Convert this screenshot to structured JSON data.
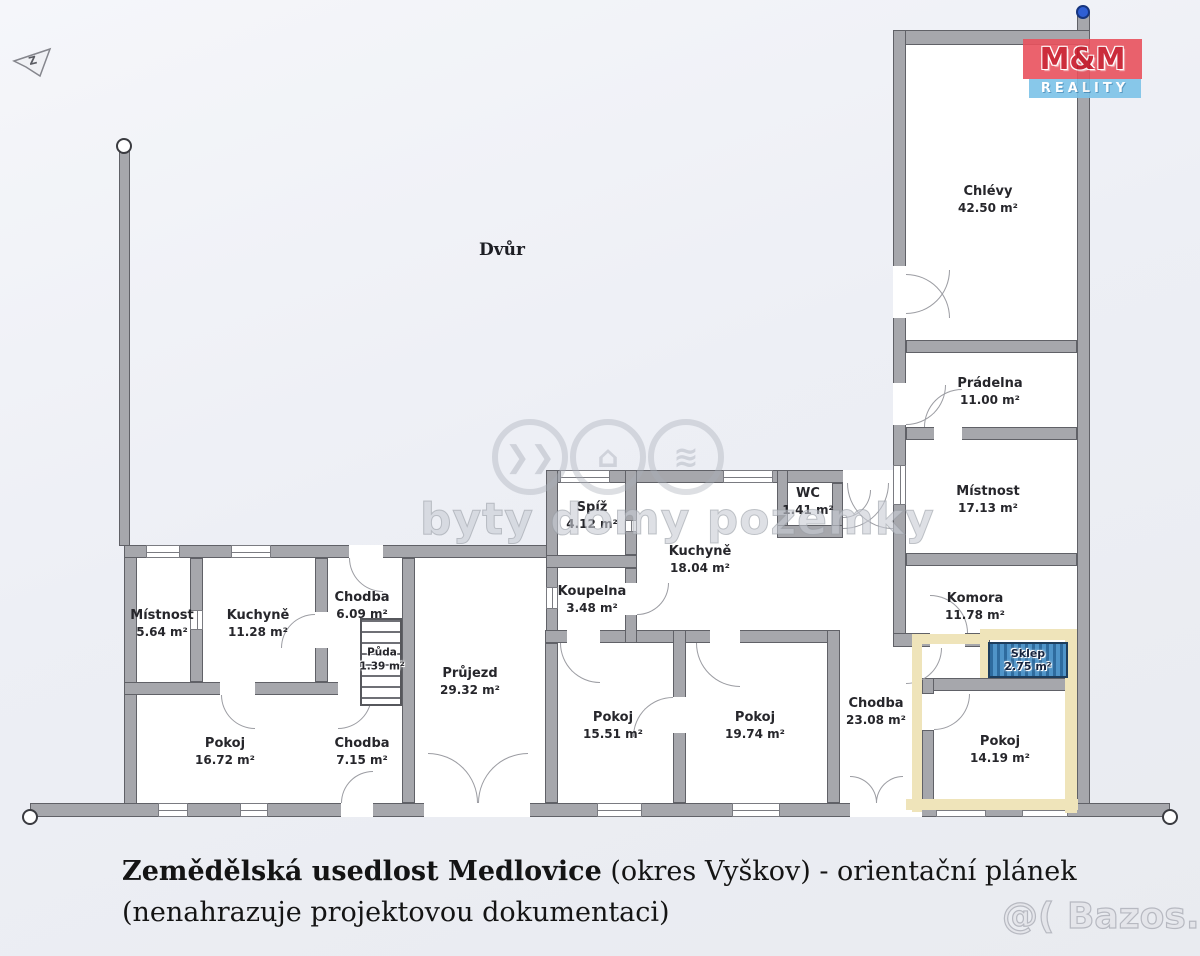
{
  "compass": {
    "letter": "Z"
  },
  "courtyard": {
    "label": "Dvůr"
  },
  "rooms": {
    "chlevy": {
      "name": "Chlévy",
      "area": "42.50 m²"
    },
    "pradelna": {
      "name": "Prádelna",
      "area": "11.00 m²"
    },
    "mistnost17": {
      "name": "Místnost",
      "area": "17.13 m²"
    },
    "komora": {
      "name": "Komora",
      "area": "11.78 m²"
    },
    "sklep": {
      "name": "Sklep",
      "area": "2.75 m²"
    },
    "pokoj14": {
      "name": "Pokoj",
      "area": "14.19 m²"
    },
    "spiz": {
      "name": "Spíž",
      "area": "4.12 m²"
    },
    "kuchyne18": {
      "name": "Kuchyně",
      "area": "18.04 m²"
    },
    "wc": {
      "name": "WC",
      "area": "1.41 m²"
    },
    "koupelna": {
      "name": "Koupelna",
      "area": "3.48 m²"
    },
    "mistnost5": {
      "name": "Místnost",
      "area": "5.64 m²"
    },
    "kuchyne11": {
      "name": "Kuchyně",
      "area": "11.28 m²"
    },
    "chodba6": {
      "name": "Chodba",
      "area": "6.09 m²"
    },
    "puda": {
      "name": "Půda",
      "area": "1.39 m²"
    },
    "pokoj16": {
      "name": "Pokoj",
      "area": "16.72 m²"
    },
    "chodba7": {
      "name": "Chodba",
      "area": "7.15 m²"
    },
    "prujezd": {
      "name": "Průjezd",
      "area": "29.32 m²"
    },
    "pokoj15": {
      "name": "Pokoj",
      "area": "15.51 m²"
    },
    "pokoj19": {
      "name": "Pokoj",
      "area": "19.74 m²"
    },
    "chodba23": {
      "name": "Chodba",
      "area": "23.08 m²"
    }
  },
  "logo": {
    "top": "M&M",
    "bottom": "REALITY"
  },
  "watermark": {
    "center_text": "byty domy pozemky",
    "bottom_right": "@( Bazos.cz"
  },
  "caption": {
    "title_bold": "Zemědělská usedlost Medlovice",
    "title_rest": " (okres Vyškov) - orientační plánek",
    "line2": "(nenahrazuje projektovou dokumentaci)"
  },
  "colors": {
    "wall": "#a6a7ac",
    "highlight": "#efe4ba",
    "sklep_fill": "#4a90c4",
    "logo_red": "#e9525e",
    "logo_blue": "#7cc3e8",
    "marker_blue": "#2f5fd4"
  }
}
